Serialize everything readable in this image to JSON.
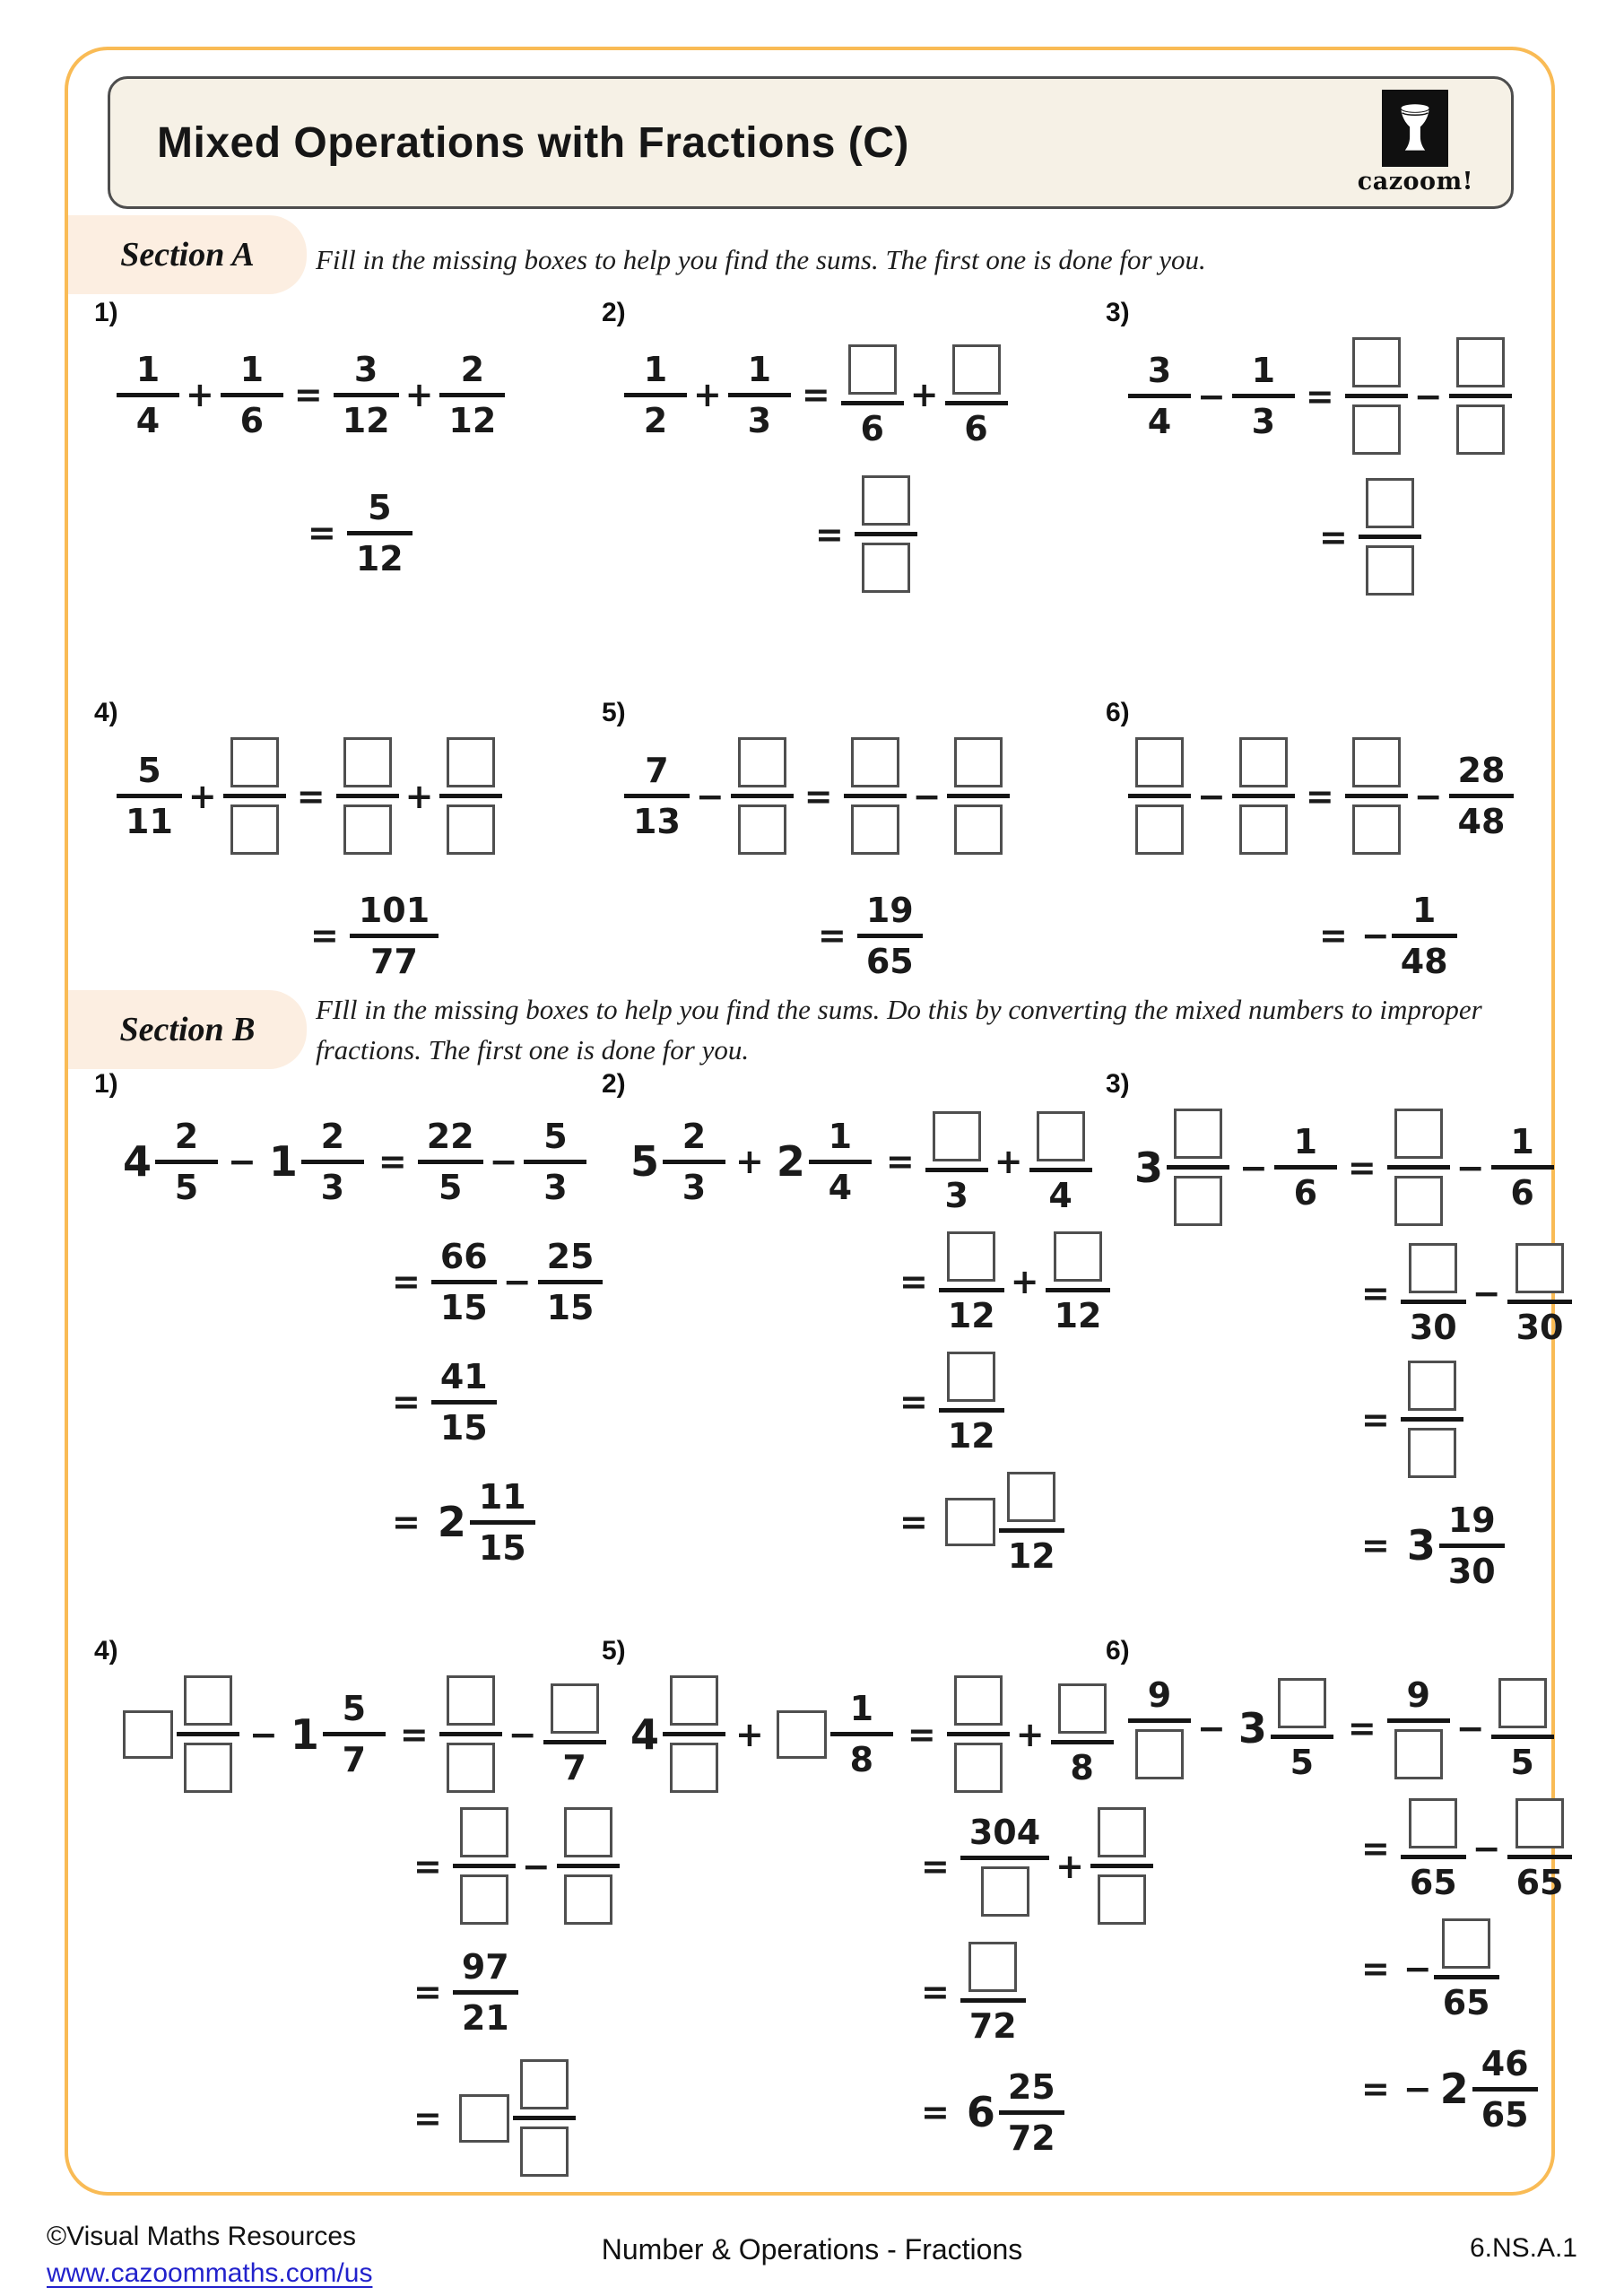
{
  "page": {
    "title": "Mixed Operations with Fractions (C)",
    "logo": {
      "brand": "cazoom!",
      "icon": "drum-icon"
    },
    "colors": {
      "frame": "#F9BB55",
      "header_bg": "#F6F1E6",
      "header_border": "#4d4d4d",
      "section_label_bg": "#FCEEE1",
      "box_border": "#4f4f4f",
      "link": "#2222CC",
      "ink": "#1a1a1a"
    },
    "sections": [
      {
        "label": "Section A",
        "instructions": "Fill in the missing boxes to help you find the sums. The first one is done for you.",
        "problems": [
          {
            "num": "1)",
            "lines": [
              [
                [
                  "fr",
                  "1",
                  "4"
                ],
                [
                  "op",
                  "+"
                ],
                [
                  "fr",
                  "1",
                  "6"
                ],
                [
                  "op",
                  "="
                ],
                [
                  "fr",
                  "3",
                  "12"
                ],
                [
                  "op",
                  "+"
                ],
                [
                  "fr",
                  "2",
                  "12"
                ]
              ],
              [
                [
                  "op",
                  "="
                ],
                [
                  "fr",
                  "5",
                  "12"
                ]
              ]
            ]
          },
          {
            "num": "2)",
            "lines": [
              [
                [
                  "fr",
                  "1",
                  "2"
                ],
                [
                  "op",
                  "+"
                ],
                [
                  "fr",
                  "1",
                  "3"
                ],
                [
                  "op",
                  "="
                ],
                [
                  "fr",
                  "□",
                  "6"
                ],
                [
                  "op",
                  "+"
                ],
                [
                  "fr",
                  "□",
                  "6"
                ]
              ],
              [
                [
                  "op",
                  "="
                ],
                [
                  "fr",
                  "□",
                  "□"
                ]
              ]
            ]
          },
          {
            "num": "3)",
            "lines": [
              [
                [
                  "fr",
                  "3",
                  "4"
                ],
                [
                  "op",
                  "−"
                ],
                [
                  "fr",
                  "1",
                  "3"
                ],
                [
                  "op",
                  "="
                ],
                [
                  "fr",
                  "□",
                  "□"
                ],
                [
                  "op",
                  "−"
                ],
                [
                  "fr",
                  "□",
                  "□"
                ]
              ],
              [
                [
                  "op",
                  "="
                ],
                [
                  "fr",
                  "□",
                  "□"
                ]
              ]
            ]
          },
          {
            "num": "4)",
            "lines": [
              [
                [
                  "fr",
                  "5",
                  "11"
                ],
                [
                  "op",
                  "+"
                ],
                [
                  "fr",
                  "□",
                  "□"
                ],
                [
                  "op",
                  "="
                ],
                [
                  "fr",
                  "□",
                  "□"
                ],
                [
                  "op",
                  "+"
                ],
                [
                  "fr",
                  "□",
                  "□"
                ]
              ],
              [
                [
                  "op",
                  "="
                ],
                [
                  "fr",
                  "101",
                  "77"
                ]
              ]
            ]
          },
          {
            "num": "5)",
            "lines": [
              [
                [
                  "fr",
                  "7",
                  "13"
                ],
                [
                  "op",
                  "−"
                ],
                [
                  "fr",
                  "□",
                  "□"
                ],
                [
                  "op",
                  "="
                ],
                [
                  "fr",
                  "□",
                  "□"
                ],
                [
                  "op",
                  "−"
                ],
                [
                  "fr",
                  "□",
                  "□"
                ]
              ],
              [
                [
                  "op",
                  "="
                ],
                [
                  "fr",
                  "19",
                  "65"
                ]
              ]
            ]
          },
          {
            "num": "6)",
            "lines": [
              [
                [
                  "fr",
                  "□",
                  "□"
                ],
                [
                  "op",
                  "−"
                ],
                [
                  "fr",
                  "□",
                  "□"
                ],
                [
                  "op",
                  "="
                ],
                [
                  "fr",
                  "□",
                  "□"
                ],
                [
                  "op",
                  "−"
                ],
                [
                  "fr",
                  "28",
                  "48"
                ]
              ],
              [
                [
                  "op",
                  "="
                ],
                [
                  "neg"
                ],
                [
                  "fr",
                  "1",
                  "48"
                ]
              ]
            ]
          }
        ]
      },
      {
        "label": "Section B",
        "instructions": "FIll in the missing boxes to help you find the sums.  Do this by converting the mixed numbers to improper fractions. The first one is done for you.",
        "problems": [
          {
            "num": "1)",
            "lines": [
              [
                [
                  "mx",
                  "4",
                  "2",
                  "5"
                ],
                [
                  "op",
                  "−"
                ],
                [
                  "mx",
                  "1",
                  "2",
                  "3"
                ],
                [
                  "op",
                  "="
                ],
                [
                  "fr",
                  "22",
                  "5"
                ],
                [
                  "op",
                  "−"
                ],
                [
                  "fr",
                  "5",
                  "3"
                ]
              ],
              [
                [
                  "op",
                  "="
                ],
                [
                  "fr",
                  "66",
                  "15"
                ],
                [
                  "op",
                  "−"
                ],
                [
                  "fr",
                  "25",
                  "15"
                ]
              ],
              [
                [
                  "op",
                  "="
                ],
                [
                  "fr",
                  "41",
                  "15"
                ]
              ],
              [
                [
                  "op",
                  "="
                ],
                [
                  "mx",
                  "2",
                  "11",
                  "15"
                ]
              ]
            ]
          },
          {
            "num": "2)",
            "lines": [
              [
                [
                  "mx",
                  "5",
                  "2",
                  "3"
                ],
                [
                  "op",
                  "+"
                ],
                [
                  "mx",
                  "2",
                  "1",
                  "4"
                ],
                [
                  "op",
                  "="
                ],
                [
                  "fr",
                  "□",
                  "3"
                ],
                [
                  "op",
                  "+"
                ],
                [
                  "fr",
                  "□",
                  "4"
                ]
              ],
              [
                [
                  "op",
                  "="
                ],
                [
                  "fr",
                  "□",
                  "12"
                ],
                [
                  "op",
                  "+"
                ],
                [
                  "fr",
                  "□",
                  "12"
                ]
              ],
              [
                [
                  "op",
                  "="
                ],
                [
                  "fr",
                  "□",
                  "12"
                ]
              ],
              [
                [
                  "op",
                  "="
                ],
                [
                  "mx",
                  "□",
                  "□",
                  "12"
                ]
              ]
            ]
          },
          {
            "num": "3)",
            "lines": [
              [
                [
                  "mx",
                  "3",
                  "□",
                  "□"
                ],
                [
                  "op",
                  "−"
                ],
                [
                  "fr",
                  "1",
                  "6"
                ],
                [
                  "op",
                  "="
                ],
                [
                  "fr",
                  "□",
                  "□"
                ],
                [
                  "op",
                  "−"
                ],
                [
                  "fr",
                  "1",
                  "6"
                ]
              ],
              [
                [
                  "op",
                  "="
                ],
                [
                  "fr",
                  "□",
                  "30"
                ],
                [
                  "op",
                  "−"
                ],
                [
                  "fr",
                  "□",
                  "30"
                ]
              ],
              [
                [
                  "op",
                  "="
                ],
                [
                  "fr",
                  "□",
                  "□"
                ]
              ],
              [
                [
                  "op",
                  "="
                ],
                [
                  "mx",
                  "3",
                  "19",
                  "30"
                ]
              ]
            ]
          },
          {
            "num": "4)",
            "lines": [
              [
                [
                  "mx",
                  "□",
                  "□",
                  "□"
                ],
                [
                  "op",
                  "−"
                ],
                [
                  "mx",
                  "1",
                  "5",
                  "7"
                ],
                [
                  "op",
                  "="
                ],
                [
                  "fr",
                  "□",
                  "□"
                ],
                [
                  "op",
                  "−"
                ],
                [
                  "fr",
                  "□",
                  "7"
                ]
              ],
              [
                [
                  "op",
                  "="
                ],
                [
                  "fr",
                  "□",
                  "□"
                ],
                [
                  "op",
                  "−"
                ],
                [
                  "fr",
                  "□",
                  "□"
                ]
              ],
              [
                [
                  "op",
                  "="
                ],
                [
                  "fr",
                  "97",
                  "21"
                ]
              ],
              [
                [
                  "op",
                  "="
                ],
                [
                  "mx",
                  "□",
                  "□",
                  "□"
                ]
              ]
            ]
          },
          {
            "num": "5)",
            "lines": [
              [
                [
                  "mx",
                  "4",
                  "□",
                  "□"
                ],
                [
                  "op",
                  "+"
                ],
                [
                  "mx",
                  "□",
                  "1",
                  "8"
                ],
                [
                  "op",
                  "="
                ],
                [
                  "fr",
                  "□",
                  "□"
                ],
                [
                  "op",
                  "+"
                ],
                [
                  "fr",
                  "□",
                  "8"
                ]
              ],
              [
                [
                  "op",
                  "="
                ],
                [
                  "fr",
                  "304",
                  "□"
                ],
                [
                  "op",
                  "+"
                ],
                [
                  "fr",
                  "□",
                  "□"
                ]
              ],
              [
                [
                  "op",
                  "="
                ],
                [
                  "fr",
                  "□",
                  "72"
                ]
              ],
              [
                [
                  "op",
                  "="
                ],
                [
                  "mx",
                  "6",
                  "25",
                  "72"
                ]
              ]
            ]
          },
          {
            "num": "6)",
            "lines": [
              [
                [
                  "fr",
                  "9",
                  "□"
                ],
                [
                  "op",
                  "−"
                ],
                [
                  "mx",
                  "3",
                  "□",
                  "5"
                ],
                [
                  "op",
                  "="
                ],
                [
                  "fr",
                  "9",
                  "□"
                ],
                [
                  "op",
                  "−"
                ],
                [
                  "fr",
                  "□",
                  "5"
                ]
              ],
              [
                [
                  "op",
                  "="
                ],
                [
                  "fr",
                  "□",
                  "65"
                ],
                [
                  "op",
                  "−"
                ],
                [
                  "fr",
                  "□",
                  "65"
                ]
              ],
              [
                [
                  "op",
                  "="
                ],
                [
                  "neg"
                ],
                [
                  "fr",
                  "□",
                  "65"
                ]
              ],
              [
                [
                  "op",
                  "="
                ],
                [
                  "neg"
                ],
                [
                  "mx",
                  "2",
                  "46",
                  "65"
                ]
              ]
            ]
          }
        ]
      }
    ],
    "footer": {
      "copyright": "©Visual Maths Resources",
      "link": "www.cazoommaths.com/us",
      "center": "Number & Operations - Fractions",
      "code": "6.NS.A.1"
    }
  }
}
